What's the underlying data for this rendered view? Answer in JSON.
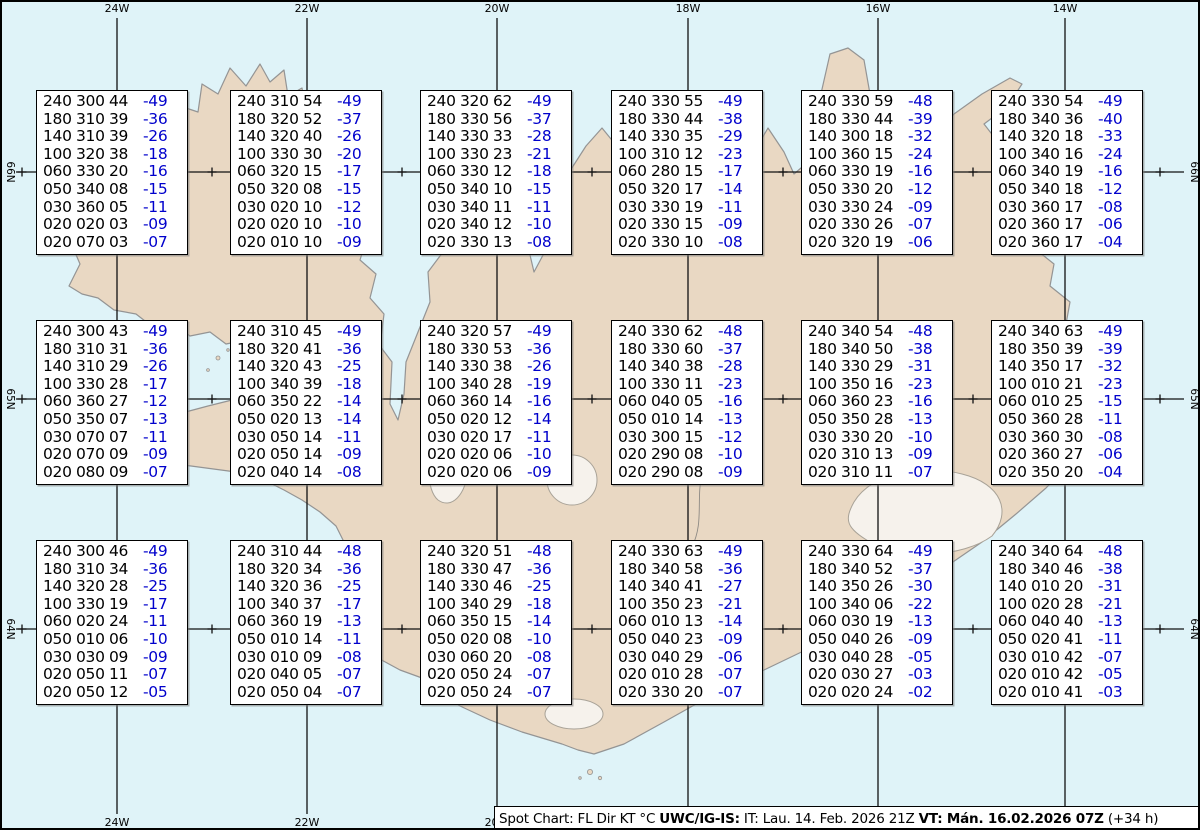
{
  "map": {
    "sea_color": "#dff3f8",
    "land_color": "#e9d8c3",
    "coast_color": "#949494",
    "grid_color": "#111111",
    "region_name": "iceland",
    "lon_gridlines": [
      {
        "label": "24W",
        "x": 115
      },
      {
        "label": "22W",
        "x": 305
      },
      {
        "label": "20W",
        "x": 495
      },
      {
        "label": "18W",
        "x": 686
      },
      {
        "label": "16W",
        "x": 876
      },
      {
        "label": "14W",
        "x": 1063
      }
    ],
    "lat_gridlines": [
      {
        "label": "66N",
        "y": 170
      },
      {
        "label": "65N",
        "y": 397
      },
      {
        "label": "64N",
        "y": 627
      }
    ],
    "minor_lon_x": [
      20,
      210,
      400,
      590,
      781,
      971,
      1158
    ],
    "bottom_lon_labels": [
      {
        "label": "24W",
        "x": 115
      },
      {
        "label": "22W",
        "x": 305
      },
      {
        "label": "20W",
        "x": 495
      }
    ]
  },
  "footer": {
    "segments": [
      {
        "text": "Spot Chart: FL Dir KT °C ",
        "bold": false
      },
      {
        "text": "UWC/IG-IS:",
        "bold": true
      },
      {
        "text": " IT: Lau. 14. Feb. 2026 21Z ",
        "bold": false
      },
      {
        "text": "VT: Mán. 16.02.2026 07Z",
        "bold": true
      },
      {
        "text": " (+34 h)",
        "bold": false
      }
    ]
  },
  "chart_data": {
    "type": "table",
    "title": "Spot Chart: FL Dir KT °C",
    "subtitle": "UWC/IG-IS winds and temperatures aloft, VT Mán. 16.02.2026 07Z (+34 h)",
    "columns": [
      "FL",
      "Dir",
      "KT",
      "TempC"
    ],
    "temp_color": "#0000cc",
    "stations": [
      {
        "id": "r1c1",
        "x": 34,
        "y": 88,
        "rows": [
          [
            "240",
            "300",
            "44",
            "-49"
          ],
          [
            "180",
            "310",
            "39",
            "-36"
          ],
          [
            "140",
            "310",
            "39",
            "-26"
          ],
          [
            "100",
            "320",
            "38",
            "-18"
          ],
          [
            "060",
            "330",
            "20",
            "-16"
          ],
          [
            "050",
            "340",
            "08",
            "-15"
          ],
          [
            "030",
            "360",
            "05",
            "-11"
          ],
          [
            "020",
            "020",
            "03",
            "-09"
          ],
          [
            "020",
            "070",
            "03",
            "-07"
          ]
        ]
      },
      {
        "id": "r1c2",
        "x": 228,
        "y": 88,
        "rows": [
          [
            "240",
            "310",
            "54",
            "-49"
          ],
          [
            "180",
            "320",
            "52",
            "-37"
          ],
          [
            "140",
            "320",
            "40",
            "-26"
          ],
          [
            "100",
            "330",
            "30",
            "-20"
          ],
          [
            "060",
            "320",
            "15",
            "-17"
          ],
          [
            "050",
            "320",
            "08",
            "-15"
          ],
          [
            "030",
            "020",
            "10",
            "-12"
          ],
          [
            "020",
            "020",
            "10",
            "-10"
          ],
          [
            "020",
            "010",
            "10",
            "-09"
          ]
        ]
      },
      {
        "id": "r1c3",
        "x": 418,
        "y": 88,
        "rows": [
          [
            "240",
            "320",
            "62",
            "-49"
          ],
          [
            "180",
            "330",
            "56",
            "-37"
          ],
          [
            "140",
            "330",
            "33",
            "-28"
          ],
          [
            "100",
            "330",
            "23",
            "-21"
          ],
          [
            "060",
            "330",
            "12",
            "-18"
          ],
          [
            "050",
            "340",
            "10",
            "-15"
          ],
          [
            "030",
            "340",
            "11",
            "-11"
          ],
          [
            "020",
            "340",
            "12",
            "-10"
          ],
          [
            "020",
            "330",
            "13",
            "-08"
          ]
        ]
      },
      {
        "id": "r1c4",
        "x": 609,
        "y": 88,
        "rows": [
          [
            "240",
            "330",
            "55",
            "-49"
          ],
          [
            "180",
            "330",
            "44",
            "-38"
          ],
          [
            "140",
            "330",
            "35",
            "-29"
          ],
          [
            "100",
            "310",
            "12",
            "-23"
          ],
          [
            "060",
            "280",
            "15",
            "-17"
          ],
          [
            "050",
            "320",
            "17",
            "-14"
          ],
          [
            "030",
            "330",
            "19",
            "-11"
          ],
          [
            "020",
            "330",
            "15",
            "-09"
          ],
          [
            "020",
            "330",
            "10",
            "-08"
          ]
        ]
      },
      {
        "id": "r1c5",
        "x": 799,
        "y": 88,
        "rows": [
          [
            "240",
            "330",
            "59",
            "-48"
          ],
          [
            "180",
            "330",
            "44",
            "-39"
          ],
          [
            "140",
            "300",
            "18",
            "-32"
          ],
          [
            "100",
            "360",
            "15",
            "-24"
          ],
          [
            "060",
            "330",
            "19",
            "-16"
          ],
          [
            "050",
            "330",
            "20",
            "-12"
          ],
          [
            "030",
            "330",
            "24",
            "-09"
          ],
          [
            "020",
            "330",
            "26",
            "-07"
          ],
          [
            "020",
            "320",
            "19",
            "-06"
          ]
        ]
      },
      {
        "id": "r1c6",
        "x": 989,
        "y": 88,
        "rows": [
          [
            "240",
            "330",
            "54",
            "-49"
          ],
          [
            "180",
            "340",
            "36",
            "-40"
          ],
          [
            "140",
            "320",
            "18",
            "-33"
          ],
          [
            "100",
            "340",
            "16",
            "-24"
          ],
          [
            "060",
            "340",
            "19",
            "-16"
          ],
          [
            "050",
            "340",
            "18",
            "-12"
          ],
          [
            "030",
            "360",
            "17",
            "-08"
          ],
          [
            "020",
            "360",
            "17",
            "-06"
          ],
          [
            "020",
            "360",
            "17",
            "-04"
          ]
        ]
      },
      {
        "id": "r2c1",
        "x": 34,
        "y": 318,
        "rows": [
          [
            "240",
            "300",
            "43",
            "-49"
          ],
          [
            "180",
            "310",
            "31",
            "-36"
          ],
          [
            "140",
            "310",
            "29",
            "-26"
          ],
          [
            "100",
            "330",
            "28",
            "-17"
          ],
          [
            "060",
            "360",
            "27",
            "-12"
          ],
          [
            "050",
            "350",
            "07",
            "-13"
          ],
          [
            "030",
            "070",
            "07",
            "-11"
          ],
          [
            "020",
            "070",
            "09",
            "-09"
          ],
          [
            "020",
            "080",
            "09",
            "-07"
          ]
        ]
      },
      {
        "id": "r2c2",
        "x": 228,
        "y": 318,
        "rows": [
          [
            "240",
            "310",
            "45",
            "-49"
          ],
          [
            "180",
            "320",
            "41",
            "-36"
          ],
          [
            "140",
            "320",
            "43",
            "-25"
          ],
          [
            "100",
            "340",
            "39",
            "-18"
          ],
          [
            "060",
            "350",
            "22",
            "-14"
          ],
          [
            "050",
            "020",
            "13",
            "-14"
          ],
          [
            "030",
            "050",
            "14",
            "-11"
          ],
          [
            "020",
            "050",
            "14",
            "-09"
          ],
          [
            "020",
            "040",
            "14",
            "-08"
          ]
        ]
      },
      {
        "id": "r2c3",
        "x": 418,
        "y": 318,
        "rows": [
          [
            "240",
            "320",
            "57",
            "-49"
          ],
          [
            "180",
            "330",
            "53",
            "-36"
          ],
          [
            "140",
            "330",
            "38",
            "-26"
          ],
          [
            "100",
            "340",
            "28",
            "-19"
          ],
          [
            "060",
            "360",
            "14",
            "-16"
          ],
          [
            "050",
            "020",
            "12",
            "-14"
          ],
          [
            "030",
            "020",
            "17",
            "-11"
          ],
          [
            "020",
            "020",
            "06",
            "-10"
          ],
          [
            "020",
            "020",
            "06",
            "-09"
          ]
        ]
      },
      {
        "id": "r2c4",
        "x": 609,
        "y": 318,
        "rows": [
          [
            "240",
            "330",
            "62",
            "-48"
          ],
          [
            "180",
            "330",
            "60",
            "-37"
          ],
          [
            "140",
            "340",
            "38",
            "-28"
          ],
          [
            "100",
            "330",
            "11",
            "-23"
          ],
          [
            "060",
            "040",
            "05",
            "-16"
          ],
          [
            "050",
            "010",
            "14",
            "-13"
          ],
          [
            "030",
            "300",
            "15",
            "-12"
          ],
          [
            "020",
            "290",
            "08",
            "-10"
          ],
          [
            "020",
            "290",
            "08",
            "-09"
          ]
        ]
      },
      {
        "id": "r2c5",
        "x": 799,
        "y": 318,
        "rows": [
          [
            "240",
            "340",
            "54",
            "-48"
          ],
          [
            "180",
            "340",
            "50",
            "-38"
          ],
          [
            "140",
            "330",
            "29",
            "-31"
          ],
          [
            "100",
            "350",
            "16",
            "-23"
          ],
          [
            "060",
            "360",
            "23",
            "-16"
          ],
          [
            "050",
            "350",
            "28",
            "-13"
          ],
          [
            "030",
            "330",
            "20",
            "-10"
          ],
          [
            "020",
            "310",
            "13",
            "-09"
          ],
          [
            "020",
            "310",
            "11",
            "-07"
          ]
        ]
      },
      {
        "id": "r2c6",
        "x": 989,
        "y": 318,
        "rows": [
          [
            "240",
            "340",
            "63",
            "-49"
          ],
          [
            "180",
            "350",
            "39",
            "-39"
          ],
          [
            "140",
            "350",
            "17",
            "-32"
          ],
          [
            "100",
            "010",
            "21",
            "-23"
          ],
          [
            "060",
            "010",
            "25",
            "-15"
          ],
          [
            "050",
            "360",
            "28",
            "-11"
          ],
          [
            "030",
            "360",
            "30",
            "-08"
          ],
          [
            "020",
            "360",
            "27",
            "-06"
          ],
          [
            "020",
            "350",
            "20",
            "-04"
          ]
        ]
      },
      {
        "id": "r3c1",
        "x": 34,
        "y": 538,
        "rows": [
          [
            "240",
            "300",
            "46",
            "-49"
          ],
          [
            "180",
            "310",
            "34",
            "-36"
          ],
          [
            "140",
            "320",
            "28",
            "-25"
          ],
          [
            "100",
            "330",
            "19",
            "-17"
          ],
          [
            "060",
            "020",
            "24",
            "-11"
          ],
          [
            "050",
            "010",
            "06",
            "-10"
          ],
          [
            "030",
            "030",
            "09",
            "-09"
          ],
          [
            "020",
            "050",
            "11",
            "-07"
          ],
          [
            "020",
            "050",
            "12",
            "-05"
          ]
        ]
      },
      {
        "id": "r3c2",
        "x": 228,
        "y": 538,
        "rows": [
          [
            "240",
            "310",
            "44",
            "-48"
          ],
          [
            "180",
            "320",
            "34",
            "-36"
          ],
          [
            "140",
            "320",
            "36",
            "-25"
          ],
          [
            "100",
            "340",
            "37",
            "-17"
          ],
          [
            "060",
            "360",
            "19",
            "-13"
          ],
          [
            "050",
            "010",
            "14",
            "-11"
          ],
          [
            "030",
            "010",
            "09",
            "-08"
          ],
          [
            "020",
            "040",
            "05",
            "-07"
          ],
          [
            "020",
            "050",
            "04",
            "-07"
          ]
        ]
      },
      {
        "id": "r3c3",
        "x": 418,
        "y": 538,
        "rows": [
          [
            "240",
            "320",
            "51",
            "-48"
          ],
          [
            "180",
            "330",
            "47",
            "-36"
          ],
          [
            "140",
            "330",
            "46",
            "-25"
          ],
          [
            "100",
            "340",
            "29",
            "-18"
          ],
          [
            "060",
            "350",
            "15",
            "-14"
          ],
          [
            "050",
            "020",
            "08",
            "-10"
          ],
          [
            "030",
            "060",
            "20",
            "-08"
          ],
          [
            "020",
            "050",
            "24",
            "-07"
          ],
          [
            "020",
            "050",
            "24",
            "-07"
          ]
        ]
      },
      {
        "id": "r3c4",
        "x": 609,
        "y": 538,
        "rows": [
          [
            "240",
            "330",
            "63",
            "-49"
          ],
          [
            "180",
            "340",
            "58",
            "-36"
          ],
          [
            "140",
            "340",
            "41",
            "-27"
          ],
          [
            "100",
            "350",
            "23",
            "-21"
          ],
          [
            "060",
            "010",
            "13",
            "-14"
          ],
          [
            "050",
            "040",
            "23",
            "-09"
          ],
          [
            "030",
            "040",
            "29",
            "-06"
          ],
          [
            "020",
            "010",
            "28",
            "-07"
          ],
          [
            "020",
            "330",
            "20",
            "-07"
          ]
        ]
      },
      {
        "id": "r3c5",
        "x": 799,
        "y": 538,
        "rows": [
          [
            "240",
            "330",
            "64",
            "-49"
          ],
          [
            "180",
            "340",
            "52",
            "-37"
          ],
          [
            "140",
            "350",
            "26",
            "-30"
          ],
          [
            "100",
            "340",
            "06",
            "-22"
          ],
          [
            "060",
            "030",
            "19",
            "-13"
          ],
          [
            "050",
            "040",
            "26",
            "-09"
          ],
          [
            "030",
            "040",
            "28",
            "-05"
          ],
          [
            "020",
            "030",
            "27",
            "-03"
          ],
          [
            "020",
            "020",
            "24",
            "-02"
          ]
        ]
      },
      {
        "id": "r3c6",
        "x": 989,
        "y": 538,
        "rows": [
          [
            "240",
            "340",
            "64",
            "-48"
          ],
          [
            "180",
            "340",
            "46",
            "-38"
          ],
          [
            "140",
            "010",
            "20",
            "-31"
          ],
          [
            "100",
            "020",
            "28",
            "-21"
          ],
          [
            "060",
            "040",
            "40",
            "-13"
          ],
          [
            "050",
            "020",
            "41",
            "-11"
          ],
          [
            "030",
            "010",
            "42",
            "-07"
          ],
          [
            "020",
            "010",
            "42",
            "-05"
          ],
          [
            "020",
            "010",
            "41",
            "-03"
          ]
        ]
      }
    ]
  }
}
